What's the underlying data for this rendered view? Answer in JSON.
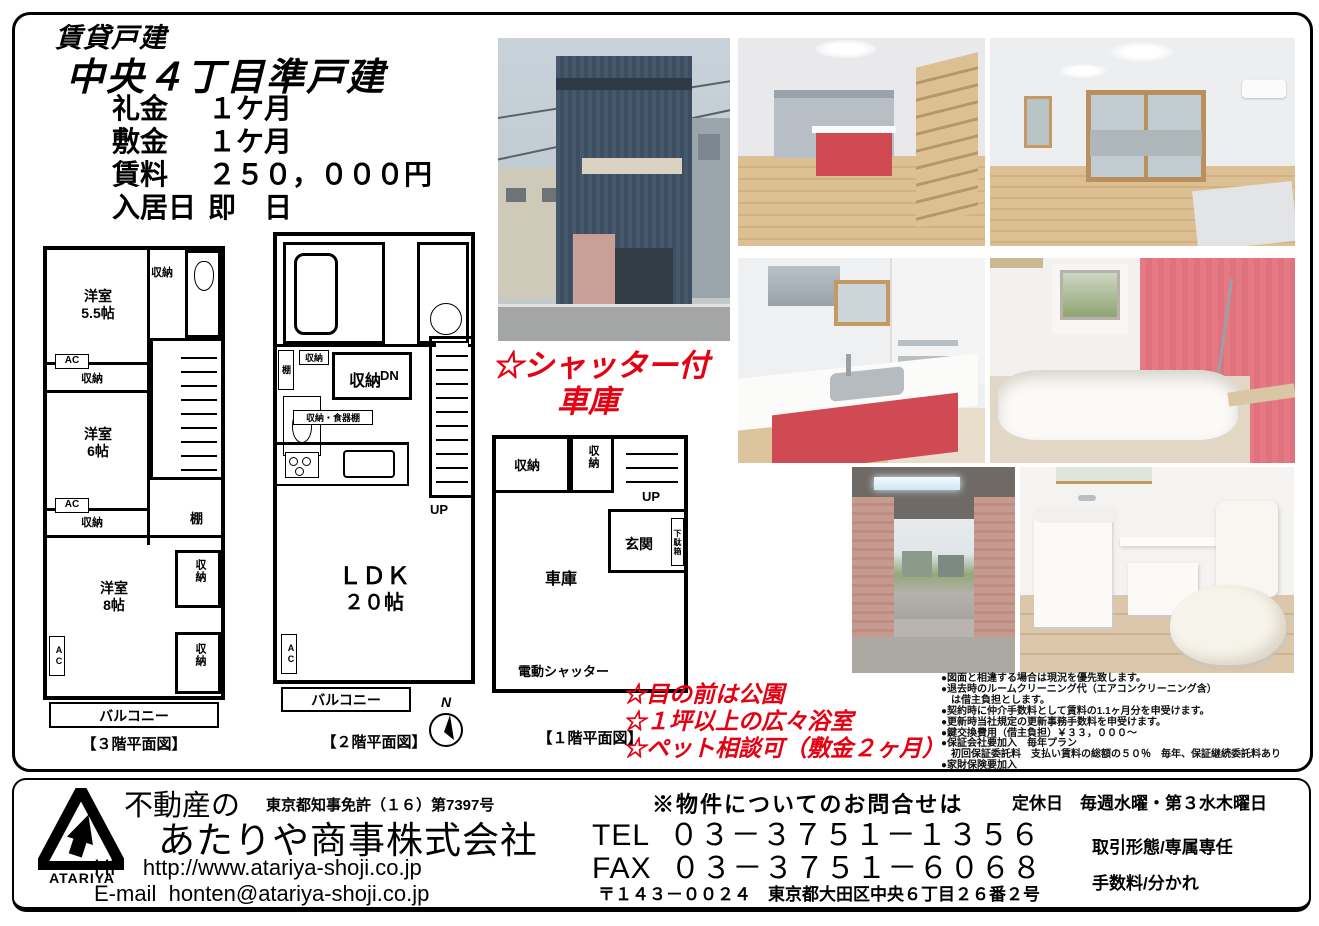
{
  "accent": {
    "red": "#e60012",
    "black": "#000000"
  },
  "header": {
    "category": "賃貸戸建",
    "title": "中央４丁目準戸建",
    "terms": [
      {
        "label": "礼金",
        "value": "１ケ月"
      },
      {
        "label": "敷金",
        "value": "１ケ月"
      },
      {
        "label": "賃料",
        "value": "２５０，０００円"
      },
      {
        "label": "入居日",
        "value": "即　日"
      }
    ]
  },
  "highlights": {
    "shutter_line1": "☆シャッター付",
    "shutter_line2": "車庫",
    "park": "☆目の前は公園",
    "bath": "☆１坪以上の広々浴室",
    "pet": "☆ペット相談可（敷金２ヶ月）"
  },
  "plan_labels": {
    "room": "洋室",
    "size55": "5.5帖",
    "size6": "6帖",
    "size8": "8帖",
    "storage": "収納",
    "ac": "AC",
    "shelf": "棚",
    "balcony": "バルコニー",
    "ldk": "ＬＤＫ",
    "ldk_size": "２０帖",
    "dn": "DN",
    "up": "UP",
    "storage_dish": "収納・食器棚",
    "entrance": "玄関",
    "shoebox": "下駄箱",
    "garage": "車庫",
    "shutter": "電動シャッター",
    "north": "N",
    "caption_3f": "【３階平面図】",
    "caption_2f": "【２階平面図】",
    "caption_1f": "【１階平面図】"
  },
  "fine_print": {
    "lines": [
      "●図面と相違する場合は現況を優先致します。",
      "●退去時のルームクリーニング代（エアコンクリーニング含）",
      "　は借主負担とします。",
      "●契約時に仲介手数料として賃料の1.1ヶ月分を申受けます。",
      "●更新時当社規定の更新事務手数料を申受けます。",
      "●鍵交換費用（借主負担）￥３３，０００～",
      "●保証会社要加入　毎年プラン",
      "　初回保証委託料　支払い賃料の総額の５０％　毎年、保証継続委託料あり",
      "●家財保険要加入"
    ]
  },
  "footer": {
    "logo_text": "ATARIYA",
    "tagline": "不動産の",
    "license": "東京都知事免許（１６）第7397号",
    "company": "あたりや商事株式会社",
    "hp_label": "HP",
    "hp_url": "http://www.atariya-shoji.co.jp",
    "email_label": "E-mail",
    "email": "honten@atariya-shoji.co.jp",
    "inquiry": "※物件についてのお問合せは",
    "tel_label": "TEL",
    "tel": "０３－３７５１－１３５６",
    "fax_label": "FAX",
    "fax": "０３－３７５１－６０６８",
    "address": "〒１４３－００２４　東京都大田区中央６丁目２６番２号",
    "closed": "定休日　毎週水曜・第３水木曜日",
    "deal_type": "取引形態/専属専任",
    "fee": "手数料/分かれ"
  }
}
